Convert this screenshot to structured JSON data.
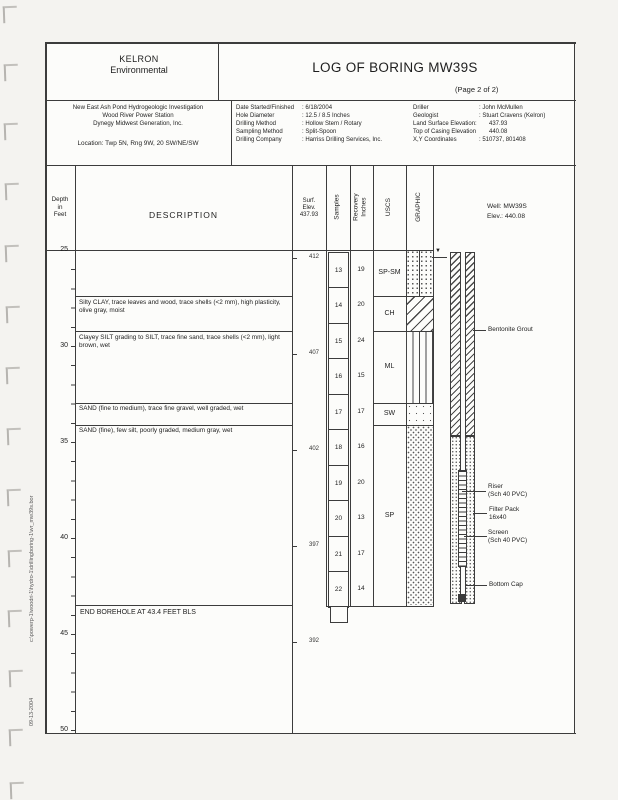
{
  "header": {
    "company_line1": "KELRON",
    "company_line2": "Environmental",
    "title": "LOG OF BORING MW39S",
    "page_label": "(Page 2 of 2)"
  },
  "project": {
    "line1": "New East Ash Pond Hydrogeologic Investigation",
    "line2": "Wood River Power Station",
    "line3": "Dynegy Midwest Generation, Inc.",
    "location": "Location: Twp 5N, Rng 9W, 20 SW/NE/SW"
  },
  "drilling_info": {
    "rows": [
      {
        "label": "Date Started/Finished",
        "value": ": 6/18/2004"
      },
      {
        "label": "Hole Diameter",
        "value": ": 12.5 / 8.5 Inches"
      },
      {
        "label": "Drilling Method",
        "value": ": Hollow Stem / Rotary"
      },
      {
        "label": "Sampling Method",
        "value": ": Split-Spoon"
      },
      {
        "label": "Drilling Company",
        "value": ": Harriss Drilling Services, Inc."
      }
    ]
  },
  "site_info": {
    "rows": [
      {
        "label": "Driller",
        "value": ": John McMullen"
      },
      {
        "label": "Geologist",
        "value": ": Stuart Cravens (Kelron)"
      },
      {
        "label": "Land Surface Elevation:",
        "value": "437.93"
      },
      {
        "label": "Top of Casing Elevation",
        "value": "440.08"
      },
      {
        "label": "X,Y Coordinates",
        "value": ": 510737, 801408"
      }
    ]
  },
  "table_header": {
    "depth": "Depth\nin\nFeet",
    "description": "DESCRIPTION",
    "surf_elev": "Surf.\nElev.\n437.93",
    "samples": "Samples",
    "recovery": "Recovery\nInches",
    "uscs": "USCS",
    "graphic": "GRAPHIC"
  },
  "log": {
    "depth_labels": [
      "25",
      "30",
      "35",
      "40",
      "45",
      "50"
    ],
    "elev_labels": [
      "412",
      "407",
      "402",
      "397",
      "392"
    ],
    "uscs_labels": [
      "SP-SM",
      "CH",
      "ML",
      "SW",
      "SP"
    ],
    "descriptions": {
      "ch": "Silty CLAY, trace leaves and wood, trace shells (<2 mm), high plasticity, olive gray, moist",
      "ml": "Clayey SILT grading to SILT, trace fine sand, trace shells (<2 mm), light brown, wet",
      "sw": "SAND (fine to medium), trace fine gravel, well graded, wet",
      "sp": "SAND (fine), few silt, poorly graded, medium gray, wet"
    },
    "samples": [
      {
        "n": "13",
        "rec": "19"
      },
      {
        "n": "14",
        "rec": "20"
      },
      {
        "n": "15",
        "rec": "24"
      },
      {
        "n": "16",
        "rec": "15"
      },
      {
        "n": "17",
        "rec": "17"
      },
      {
        "n": "18",
        "rec": "16"
      },
      {
        "n": "19",
        "rec": "20"
      },
      {
        "n": "20",
        "rec": "13"
      },
      {
        "n": "21",
        "rec": "17"
      },
      {
        "n": "22",
        "rec": "14"
      }
    ],
    "end_note": "END BOREHOLE AT 43.4 FEET BLS"
  },
  "well": {
    "header_line1": "Well: MW39S",
    "header_line2": "Elev.: 440.08",
    "labels": {
      "grout": "Bentonite Grout",
      "riser": "Riser\n(Sch 40 PVC)",
      "filter": "Filter Pack\n16x40",
      "screen": "Screen\n(Sch 40 PVC)",
      "cap": "Bottom Cap"
    },
    "water_symbol": "▼"
  },
  "margin_notes": {
    "file_path": "c:\\powerp-1\\woodri-1\\hydro-1\\drillingboring-1\\wr_mw39s.bor",
    "date": "09-13-2004"
  },
  "colors": {
    "ink": "#1e1e1e",
    "line": "#3c3c3c",
    "paper": "#fcfcfa",
    "binding": "#b6b4b0"
  }
}
